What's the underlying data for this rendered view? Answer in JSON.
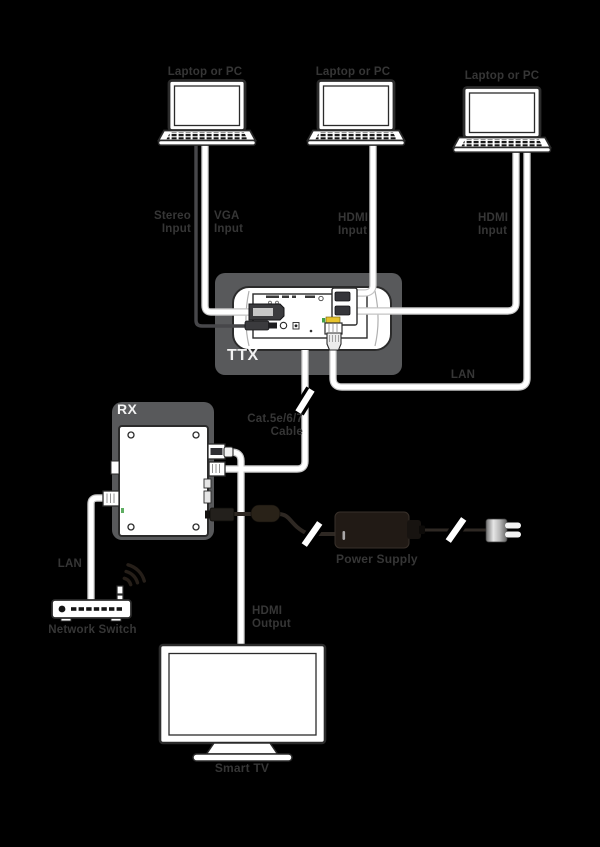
{
  "labels": {
    "laptop1": "Laptop or PC",
    "laptop2": "Laptop or PC",
    "laptop3": "Laptop or PC",
    "stereo_input": "Stereo\nInput",
    "vga_input": "VGA\nInput",
    "hdmi_input_1": "HDMI\nInput",
    "hdmi_input_2": "HDMI\nInput",
    "lan_top": "LAN",
    "ttx": "TTX",
    "cat_cable": "Cat.5e/6/7\nCable",
    "rx": "RX",
    "power_supply": "Power Supply",
    "lan_bottom": "LAN",
    "network_switch": "Network Switch",
    "hdmi_output": "HDMI\nOutput",
    "smart_tv": "Smart TV"
  },
  "colors": {
    "background": "#000000",
    "label_text": "#363636",
    "panel_gray": "#58595b",
    "panel_label_text": "#f2f2f2",
    "device_fill": "#ffffff",
    "device_outline": "#2b2b2b",
    "cable_white": "#ffffff",
    "cable_edge": "#c4c4c4",
    "stereo_cable": "#47474a",
    "power_cable": "#2e2823",
    "led_yellow": "#e7c32b",
    "led_green": "#43a047"
  }
}
